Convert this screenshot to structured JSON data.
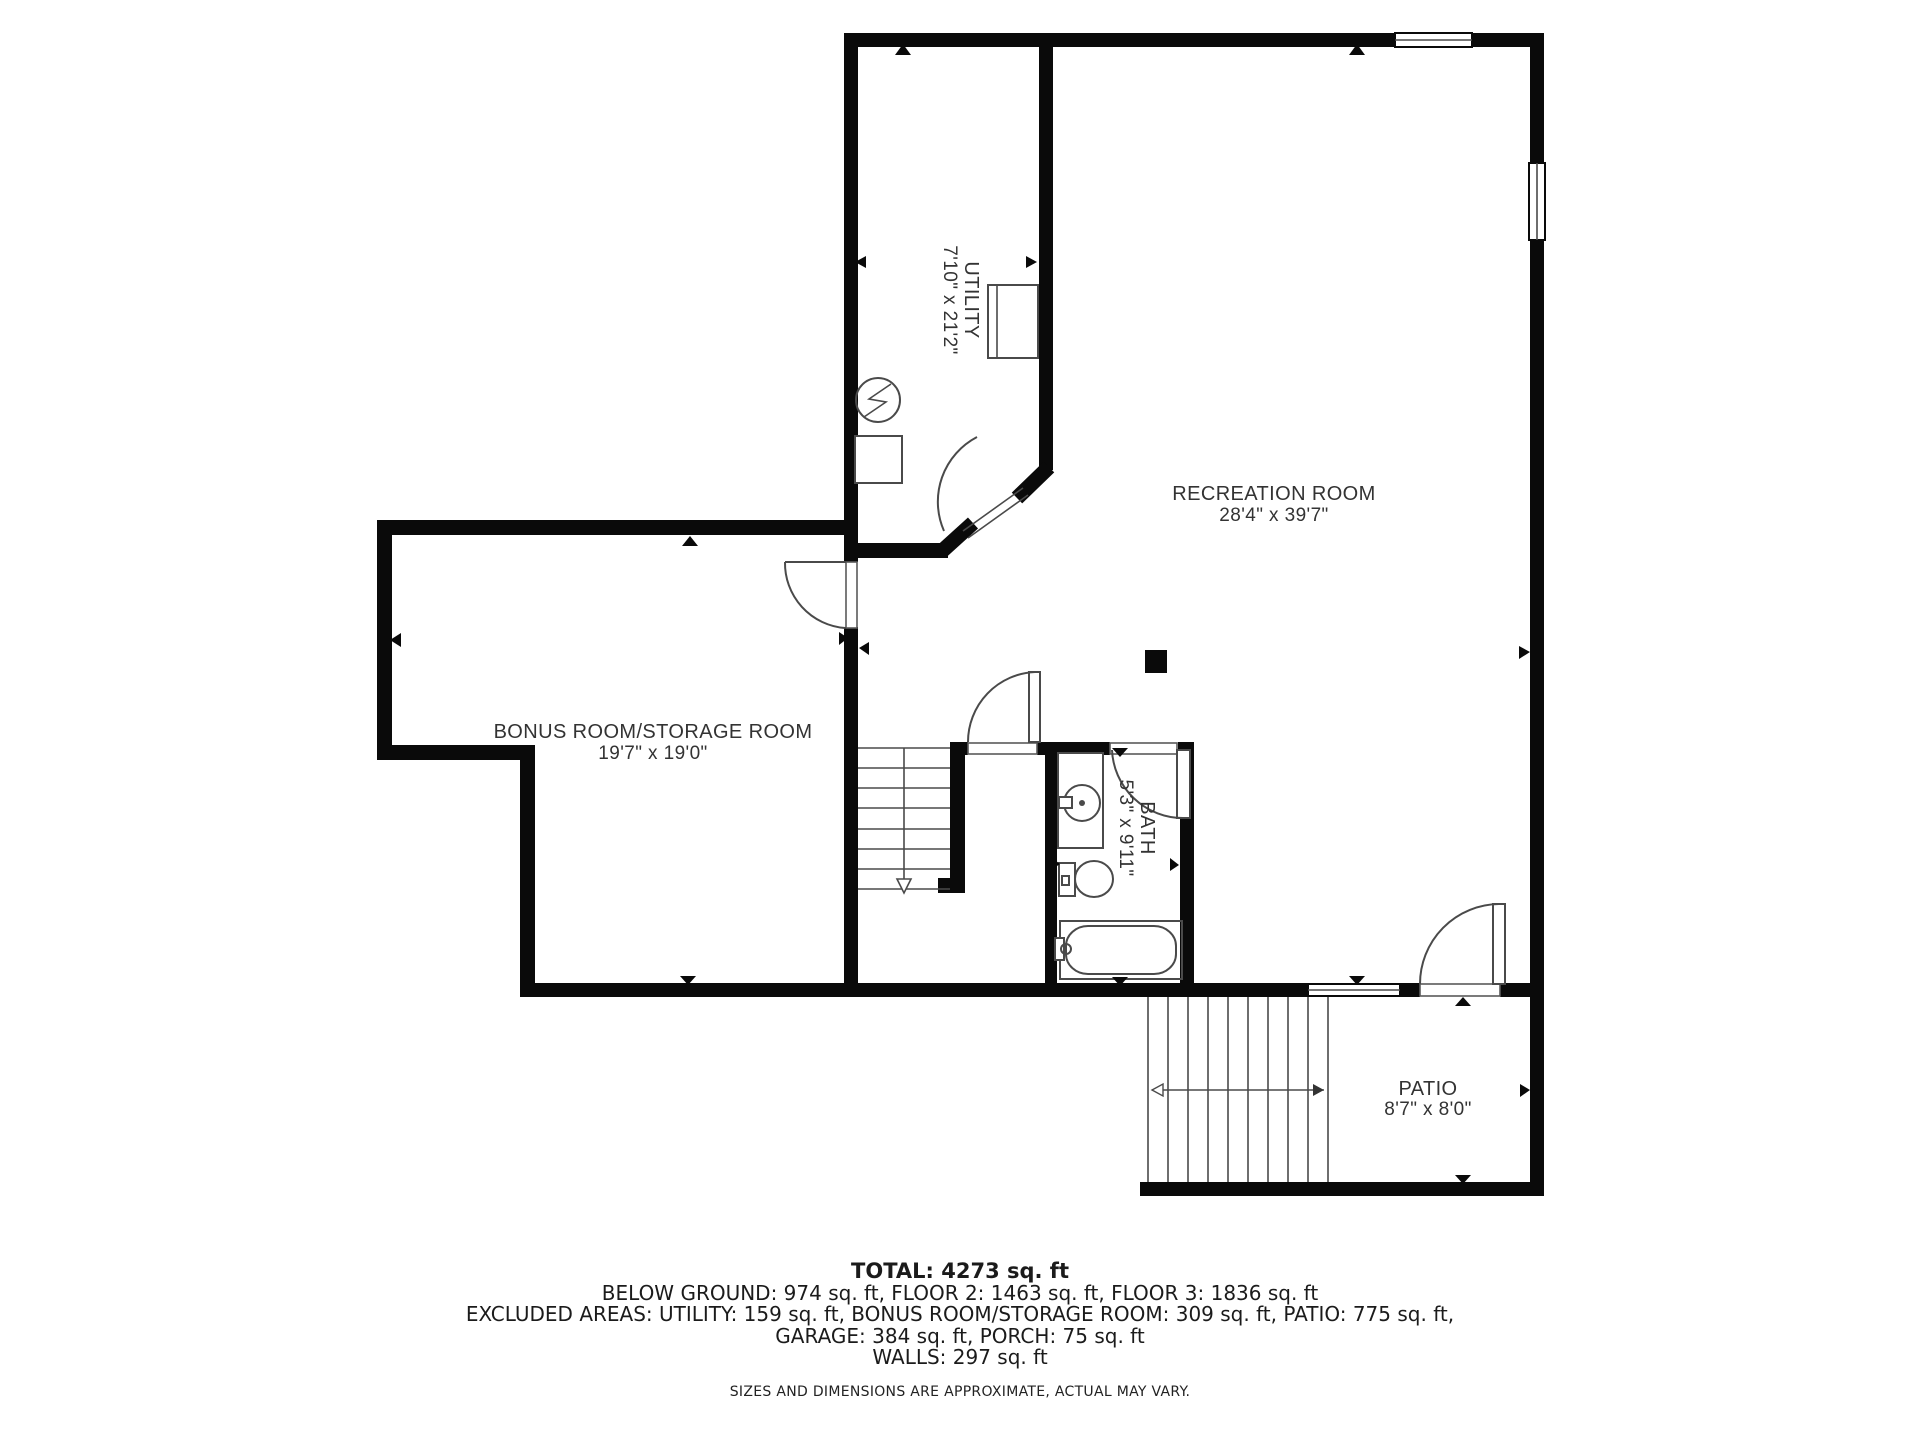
{
  "title": "Floor plan - below ground level",
  "colors": {
    "wall": "#0a0a0a",
    "fixture_line": "#4a4a4a",
    "label_text": "#333333",
    "summary_text": "#1b1b1b",
    "background": "#ffffff"
  },
  "rooms": {
    "recreation": {
      "name": "RECREATION ROOM",
      "dims": "28'4\" x 39'7\""
    },
    "utility": {
      "name": "UTILITY",
      "dims": "7'10\" x 21'2\""
    },
    "bonus": {
      "name": "BONUS ROOM/STORAGE ROOM",
      "dims": "19'7\" x 19'0\""
    },
    "bath": {
      "name": "BATH",
      "dims": "5'3\" x 9'11\""
    },
    "patio": {
      "name": "PATIO",
      "dims": "8'7\" x 8'0\""
    }
  },
  "summary": {
    "total": "TOTAL: 4273 sq. ft",
    "by_floor": "BELOW GROUND: 974 sq. ft, FLOOR 2: 1463 sq. ft, FLOOR 3: 1836 sq. ft",
    "excluded_line1": "EXCLUDED AREAS: UTILITY: 159 sq. ft, BONUS ROOM/STORAGE ROOM: 309 sq. ft, PATIO: 775 sq. ft,",
    "excluded_line2": "GARAGE: 384 sq. ft, PORCH: 75 sq. ft",
    "walls": "WALLS: 297 sq. ft",
    "disclaimer": "SIZES AND DIMENSIONS ARE APPROXIMATE, ACTUAL MAY VARY."
  }
}
